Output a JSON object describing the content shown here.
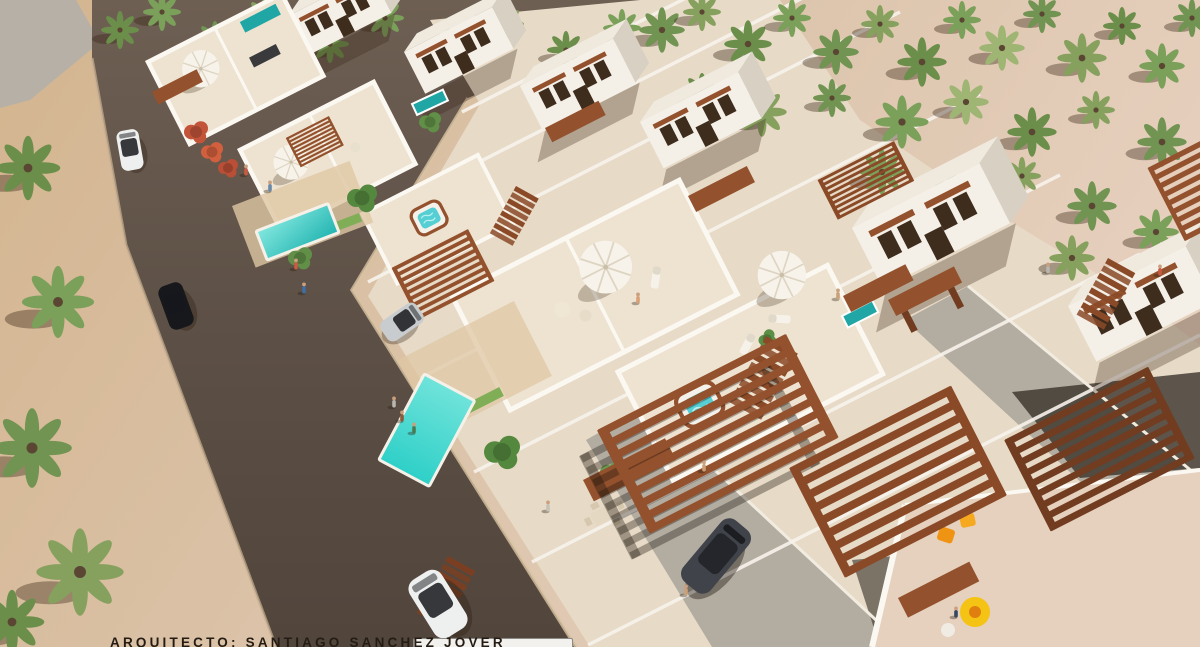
{
  "caption": {
    "label": "ARQUITECTO:",
    "architect_name": "SANTIAGO SANCHEZ JOVER",
    "full": "ARQUITECTO: SANTIAGO SANCHEZ JOVER"
  },
  "colors": {
    "sand": "#d3b48e",
    "sand_light": "#dcc4ab",
    "sand_pale": "#e6d0be",
    "road": "#5d5046",
    "road_light": "#6e5f53",
    "path_gray": "#b6b0a6",
    "estate_floor": "#e7dac6",
    "terrace_floor": "#eee3d1",
    "wall_front": "#f4efe7",
    "wall_side": "#d8d0c3",
    "roof_top": "#efe9de",
    "parapet": "#fbf8f2",
    "window_dark": "#3e2c1d",
    "wood": "#93512d",
    "wood_dark": "#713c1f",
    "pool_bright": "#2fd0c8",
    "pool_deep": "#25b5b2",
    "lap_pool": "#20a6a4",
    "drive_gray": "#b3aca1",
    "shadow_dark": "#362f28",
    "palm_green": "#719453",
    "palm_olive": "#86a05e",
    "car_white": "#eef0f0",
    "car_black": "#17181c",
    "car_gray": "#404349",
    "accent_orange": "#ef9312",
    "accent_yellow": "#f4c313",
    "caption_text": "#241c13",
    "bar_white": "#f3f1ed"
  },
  "scene": {
    "type": "aerial-3d-architectural-render",
    "subject": "residential development of white two-storey villas with roof terraces",
    "amenities": [
      "private pools",
      "rooftop jacuzzis",
      "wooden pergolas",
      "sun loungers",
      "parasols",
      "outdoor dining sets"
    ],
    "street_vehicles": [
      "white car",
      "black car",
      "white car",
      "dark grey SUV"
    ],
    "vegetation": "palm trees on sand"
  }
}
